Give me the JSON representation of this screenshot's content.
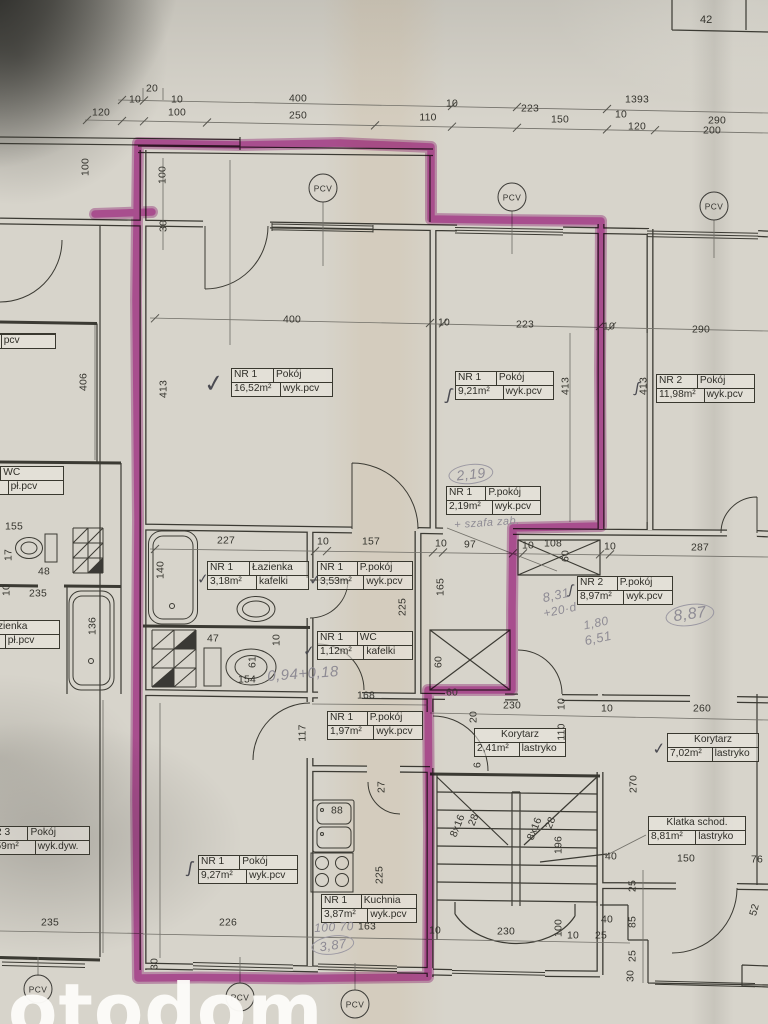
{
  "document": {
    "watermark": "otodom",
    "sheet_number": "42",
    "window_material": "PCV",
    "highlight_color": "#bd3ba6",
    "paper_color": "#d7d4cb"
  },
  "rooms": [
    {
      "nr": "NR 1",
      "name": "Pokój",
      "area": "16,52m²",
      "floor": "wyk.pcv",
      "x": 231,
      "y": 368,
      "w": 100
    },
    {
      "nr": "NR 1",
      "name": "Pokój",
      "area": "9,21m²",
      "floor": "wyk.pcv",
      "x": 455,
      "y": 371,
      "w": 97
    },
    {
      "nr": "NR 2",
      "name": "Pokój",
      "area": "11,98m²",
      "floor": "wyk.pcv",
      "x": 656,
      "y": 374,
      "w": 97
    },
    {
      "nr": "NR 1",
      "name": "P.pokój",
      "area": "2,19m²",
      "floor": "wyk.pcv",
      "x": 446,
      "y": 486,
      "w": 93
    },
    {
      "nr": "NR 1",
      "name": "Łazienka",
      "area": "3,18m²",
      "floor": "kafelki",
      "x": 207,
      "y": 561,
      "w": 100
    },
    {
      "nr": "NR 1",
      "name": "P.pokój",
      "area": "3,53m²",
      "floor": "wyk.pcv",
      "x": 317,
      "y": 561,
      "w": 94
    },
    {
      "nr": "NR 1",
      "name": "WC",
      "area": "1,12m²",
      "floor": "kafelki",
      "x": 317,
      "y": 631,
      "w": 94
    },
    {
      "nr": "NR 2",
      "name": "P.pokój",
      "area": "8,97m²",
      "floor": "wyk.pcv",
      "x": 577,
      "y": 576,
      "w": 94
    },
    {
      "nr": "NR 1",
      "name": "P.pokój",
      "area": "1,97m²",
      "floor": "wyk.pcv",
      "x": 327,
      "y": 711,
      "w": 94
    },
    {
      "nr": "",
      "name": "Korytarz",
      "area": "2,41m²",
      "floor": "lastryko",
      "x": 474,
      "y": 728,
      "w": 90
    },
    {
      "nr": "",
      "name": "Korytarz",
      "area": "7,02m²",
      "floor": "lastryko",
      "x": 667,
      "y": 733,
      "w": 90
    },
    {
      "nr": "",
      "name": "Klatka schod.",
      "area": "8,81m²",
      "floor": "lastryko",
      "x": 648,
      "y": 816,
      "w": 96
    },
    {
      "nr": "NR 1",
      "name": "Pokój",
      "area": "9,27m²",
      "floor": "wyk.pcv",
      "x": 198,
      "y": 855,
      "w": 98
    },
    {
      "nr": "NR 1",
      "name": "Kuchnia",
      "area": "3,87m²",
      "floor": "wyk.pcv",
      "x": 321,
      "y": 894,
      "w": 94
    },
    {
      "nr": "NR 3",
      "name": "Pokój",
      "area": "9,59m²",
      "floor": "wyk.dyw.",
      "x": -16,
      "y": 826,
      "w": 104
    },
    {
      "nr": "3",
      "name": "WC",
      "area": "m²",
      "floor": "pł.pcv",
      "x": -44,
      "y": 466,
      "w": 106
    },
    {
      "nr": "",
      "name": "Łazienka",
      "area": "",
      "floor": "pł.pcv",
      "x": -46,
      "y": 620,
      "w": 104
    },
    {
      "nr": "",
      "name": "",
      "area": "",
      "floor": "pcv",
      "x": -50,
      "y": 333,
      "w": 104
    }
  ],
  "dims": [
    {
      "t": "20",
      "x": 152,
      "y": 89
    },
    {
      "t": "10",
      "x": 135,
      "y": 100
    },
    {
      "t": "10",
      "x": 177,
      "y": 100
    },
    {
      "t": "400",
      "x": 298,
      "y": 99
    },
    {
      "t": "10",
      "x": 452,
      "y": 104
    },
    {
      "t": "223",
      "x": 530,
      "y": 109
    },
    {
      "t": "1393",
      "x": 637,
      "y": 100
    },
    {
      "t": "120",
      "x": 101,
      "y": 113
    },
    {
      "t": "100",
      "x": 177,
      "y": 113
    },
    {
      "t": "250",
      "x": 298,
      "y": 116
    },
    {
      "t": "110",
      "x": 428,
      "y": 118
    },
    {
      "t": "150",
      "x": 560,
      "y": 120
    },
    {
      "t": "10",
      "x": 621,
      "y": 115
    },
    {
      "t": "120",
      "x": 637,
      "y": 127
    },
    {
      "t": "290",
      "x": 717,
      "y": 121
    },
    {
      "t": "200",
      "x": 712,
      "y": 131
    },
    {
      "t": "100",
      "x": 163,
      "y": 175,
      "r": -90
    },
    {
      "t": "30",
      "x": 164,
      "y": 226,
      "r": -90
    },
    {
      "t": "100",
      "x": 86,
      "y": 167,
      "r": -90
    },
    {
      "t": "400",
      "x": 292,
      "y": 320
    },
    {
      "t": "10",
      "x": 444,
      "y": 323
    },
    {
      "t": "223",
      "x": 525,
      "y": 325
    },
    {
      "t": "10",
      "x": 609,
      "y": 327
    },
    {
      "t": "290",
      "x": 701,
      "y": 330
    },
    {
      "t": "406",
      "x": 84,
      "y": 382,
      "r": -90
    },
    {
      "t": "413",
      "x": 164,
      "y": 389,
      "r": -90
    },
    {
      "t": "413",
      "x": 566,
      "y": 386,
      "r": -90
    },
    {
      "t": "413",
      "x": 644,
      "y": 386,
      "r": -90
    },
    {
      "t": "227",
      "x": 226,
      "y": 541
    },
    {
      "t": "10",
      "x": 323,
      "y": 542
    },
    {
      "t": "157",
      "x": 371,
      "y": 542
    },
    {
      "t": "10",
      "x": 441,
      "y": 544
    },
    {
      "t": "97",
      "x": 470,
      "y": 545
    },
    {
      "t": "10",
      "x": 528,
      "y": 546
    },
    {
      "t": "108",
      "x": 553,
      "y": 544
    },
    {
      "t": "10",
      "x": 610,
      "y": 547
    },
    {
      "t": "287",
      "x": 700,
      "y": 548
    },
    {
      "t": "60",
      "x": 566,
      "y": 556,
      "r": -90
    },
    {
      "t": "140",
      "x": 161,
      "y": 570,
      "r": -90
    },
    {
      "t": "225",
      "x": 403,
      "y": 607,
      "r": -90
    },
    {
      "t": "165",
      "x": 441,
      "y": 587,
      "r": -90
    },
    {
      "t": "47",
      "x": 213,
      "y": 639
    },
    {
      "t": "10",
      "x": 277,
      "y": 640,
      "r": -90
    },
    {
      "t": "61",
      "x": 253,
      "y": 662,
      "r": -90
    },
    {
      "t": "154",
      "x": 247,
      "y": 680
    },
    {
      "t": "168",
      "x": 366,
      "y": 696
    },
    {
      "t": "60",
      "x": 439,
      "y": 662,
      "r": -90
    },
    {
      "t": "60",
      "x": 452,
      "y": 693
    },
    {
      "t": "155",
      "x": 14,
      "y": 527
    },
    {
      "t": "17",
      "x": 9,
      "y": 555,
      "r": -90
    },
    {
      "t": "48",
      "x": 44,
      "y": 572
    },
    {
      "t": "235",
      "x": 38,
      "y": 594
    },
    {
      "t": "136",
      "x": 93,
      "y": 626,
      "r": -90
    },
    {
      "t": "10",
      "x": 7,
      "y": 590,
      "r": -90
    },
    {
      "t": "230",
      "x": 512,
      "y": 706
    },
    {
      "t": "10",
      "x": 562,
      "y": 704,
      "r": -90
    },
    {
      "t": "10",
      "x": 607,
      "y": 709
    },
    {
      "t": "260",
      "x": 702,
      "y": 709
    },
    {
      "t": "20",
      "x": 474,
      "y": 717,
      "r": -90
    },
    {
      "t": "110",
      "x": 562,
      "y": 732,
      "r": -90
    },
    {
      "t": "6",
      "x": 478,
      "y": 765,
      "r": -90
    },
    {
      "t": "117",
      "x": 303,
      "y": 733,
      "r": -90
    },
    {
      "t": "270",
      "x": 634,
      "y": 784,
      "r": -90
    },
    {
      "t": "8x16",
      "x": 458,
      "y": 826,
      "r": -68
    },
    {
      "t": "28",
      "x": 474,
      "y": 820,
      "r": -68
    },
    {
      "t": "8x16",
      "x": 535,
      "y": 829,
      "r": -68
    },
    {
      "t": "28",
      "x": 551,
      "y": 823,
      "r": -68
    },
    {
      "t": "196",
      "x": 559,
      "y": 845,
      "r": -90
    },
    {
      "t": "226",
      "x": 228,
      "y": 923
    },
    {
      "t": "235",
      "x": 50,
      "y": 923
    },
    {
      "t": "30",
      "x": 155,
      "y": 964,
      "r": -90
    },
    {
      "t": "163",
      "x": 367,
      "y": 927
    },
    {
      "t": "10",
      "x": 435,
      "y": 931
    },
    {
      "t": "230",
      "x": 506,
      "y": 932
    },
    {
      "t": "100",
      "x": 559,
      "y": 928,
      "r": -90
    },
    {
      "t": "10",
      "x": 573,
      "y": 936
    },
    {
      "t": "25",
      "x": 601,
      "y": 936
    },
    {
      "t": "40",
      "x": 607,
      "y": 920
    },
    {
      "t": "40",
      "x": 611,
      "y": 857
    },
    {
      "t": "150",
      "x": 686,
      "y": 859
    },
    {
      "t": "76",
      "x": 757,
      "y": 860
    },
    {
      "t": "25",
      "x": 633,
      "y": 886,
      "r": -90
    },
    {
      "t": "85",
      "x": 633,
      "y": 922,
      "r": -90
    },
    {
      "t": "25",
      "x": 633,
      "y": 956,
      "r": -90
    },
    {
      "t": "30",
      "x": 631,
      "y": 976,
      "r": -90
    },
    {
      "t": "52",
      "x": 755,
      "y": 910,
      "r": -75
    },
    {
      "t": "27",
      "x": 382,
      "y": 787,
      "r": -90
    },
    {
      "t": "225",
      "x": 380,
      "y": 875,
      "r": -90
    },
    {
      "t": "88",
      "x": 337,
      "y": 811
    }
  ],
  "handwriting": [
    {
      "t": "2,19",
      "x": 471,
      "y": 474,
      "r": -6,
      "c": true,
      "s": 14
    },
    {
      "t": "+ szafa zab.",
      "x": 487,
      "y": 523,
      "r": -4,
      "c": false,
      "s": 11
    },
    {
      "t": "0,94+0,18",
      "x": 303,
      "y": 674,
      "r": -4,
      "c": false,
      "s": 15
    },
    {
      "t": "8,31",
      "x": 556,
      "y": 595,
      "r": -12,
      "c": false,
      "s": 13
    },
    {
      "t": "+20·d",
      "x": 560,
      "y": 610,
      "r": -12,
      "c": false,
      "s": 12
    },
    {
      "t": "1,80",
      "x": 596,
      "y": 623,
      "r": -12,
      "c": false,
      "s": 12
    },
    {
      "t": "6,51",
      "x": 598,
      "y": 638,
      "r": -12,
      "c": false,
      "s": 13
    },
    {
      "t": "8,87",
      "x": 690,
      "y": 615,
      "r": -8,
      "c": true,
      "s": 16
    },
    {
      "t": "100 70",
      "x": 334,
      "y": 927,
      "r": -3,
      "c": false,
      "s": 12
    },
    {
      "t": "3,87",
      "x": 333,
      "y": 945,
      "r": -8,
      "c": true,
      "s": 13
    }
  ],
  "marks": [
    {
      "g": "✓",
      "x": 214,
      "y": 384,
      "s": 24,
      "r": -8
    },
    {
      "g": "ʃ",
      "x": 449,
      "y": 395,
      "s": 17,
      "r": 12
    },
    {
      "g": "ʃ",
      "x": 637,
      "y": 388,
      "s": 15,
      "r": 10
    },
    {
      "g": "✓",
      "x": 203,
      "y": 579,
      "s": 14,
      "r": -5
    },
    {
      "g": "✓",
      "x": 315,
      "y": 580,
      "s": 14,
      "r": -5
    },
    {
      "g": "✓",
      "x": 309,
      "y": 651,
      "s": 14,
      "r": -5
    },
    {
      "g": "ʃ",
      "x": 571,
      "y": 589,
      "s": 14,
      "r": 12
    },
    {
      "g": "✓",
      "x": 659,
      "y": 749,
      "s": 16,
      "r": -6
    },
    {
      "g": "ʃ",
      "x": 190,
      "y": 868,
      "s": 17,
      "r": 10
    }
  ],
  "pcv_circles": [
    {
      "x": 323,
      "y": 188
    },
    {
      "x": 512,
      "y": 197
    },
    {
      "x": 714,
      "y": 206
    },
    {
      "x": 38,
      "y": 989
    },
    {
      "x": 240,
      "y": 997
    },
    {
      "x": 355,
      "y": 1004
    }
  ]
}
